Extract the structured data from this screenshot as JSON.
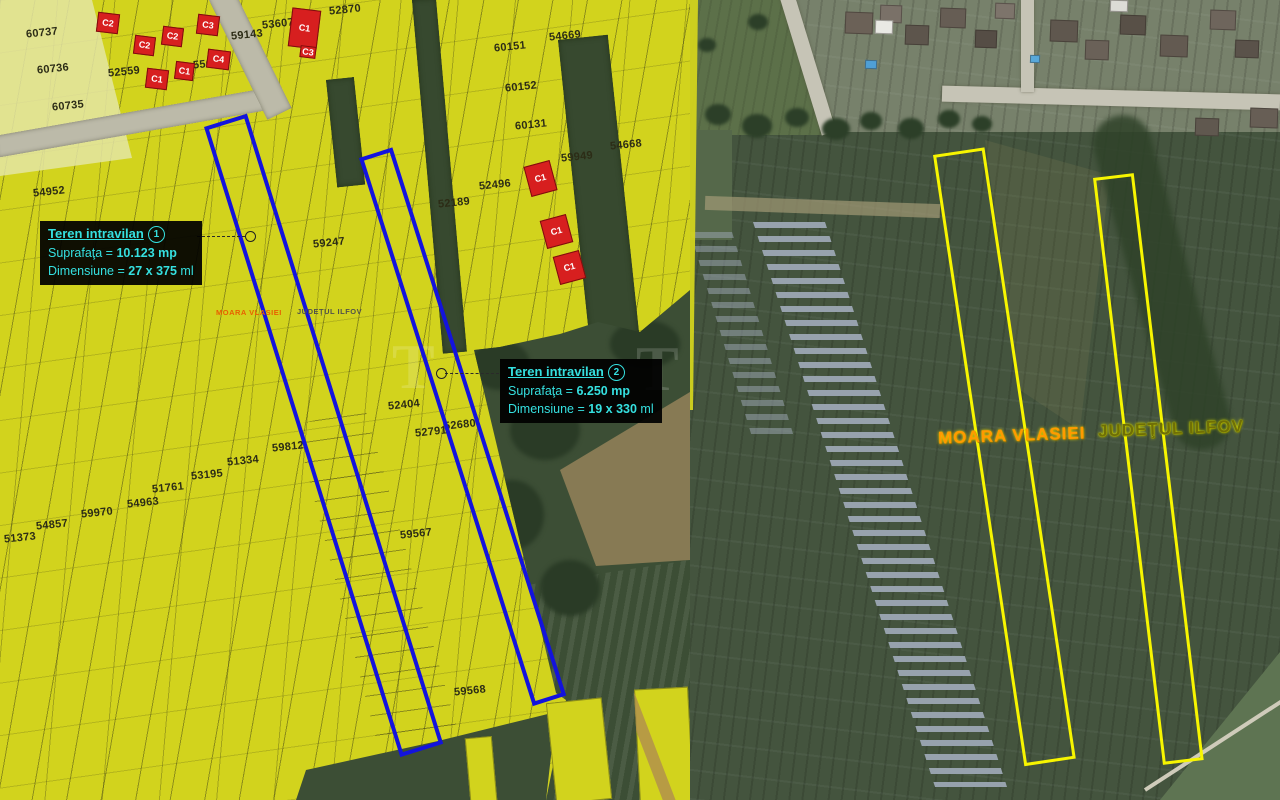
{
  "left_map": {
    "locality_label": "MOARA VLASIEI",
    "county_label": "JUDEŢUL ILFOV",
    "watermark": "T",
    "parcel_numbers": [
      {
        "num": "60737",
        "x": 26,
        "y": 27
      },
      {
        "num": "60736",
        "x": 37,
        "y": 63
      },
      {
        "num": "60735",
        "x": 52,
        "y": 100
      },
      {
        "num": "52559",
        "x": 108,
        "y": 66
      },
      {
        "num": "55695",
        "x": 193,
        "y": 58
      },
      {
        "num": "59143",
        "x": 231,
        "y": 29
      },
      {
        "num": "53607",
        "x": 262,
        "y": 18
      },
      {
        "num": "52870",
        "x": 329,
        "y": 4
      },
      {
        "num": "54669",
        "x": 549,
        "y": 30
      },
      {
        "num": "60151",
        "x": 494,
        "y": 41
      },
      {
        "num": "60152",
        "x": 505,
        "y": 81
      },
      {
        "num": "60131",
        "x": 515,
        "y": 119
      },
      {
        "num": "59949",
        "x": 561,
        "y": 151
      },
      {
        "num": "54668",
        "x": 610,
        "y": 139
      },
      {
        "num": "52496",
        "x": 479,
        "y": 179
      },
      {
        "num": "52189",
        "x": 438,
        "y": 197
      },
      {
        "num": "54952",
        "x": 33,
        "y": 186
      },
      {
        "num": "59247",
        "x": 313,
        "y": 237
      },
      {
        "num": "52404",
        "x": 388,
        "y": 399
      },
      {
        "num": "52791",
        "x": 415,
        "y": 426
      },
      {
        "num": "52680",
        "x": 444,
        "y": 419
      },
      {
        "num": "59812",
        "x": 272,
        "y": 441
      },
      {
        "num": "51334",
        "x": 227,
        "y": 455
      },
      {
        "num": "53195",
        "x": 191,
        "y": 469
      },
      {
        "num": "51761",
        "x": 152,
        "y": 482
      },
      {
        "num": "54963",
        "x": 127,
        "y": 497
      },
      {
        "num": "59970",
        "x": 81,
        "y": 507
      },
      {
        "num": "54857",
        "x": 36,
        "y": 519
      },
      {
        "num": "51373",
        "x": 4,
        "y": 532
      },
      {
        "num": "59567",
        "x": 400,
        "y": 528
      },
      {
        "num": "59568",
        "x": 454,
        "y": 685
      }
    ],
    "buildings": [
      {
        "label": "C2",
        "x": 97,
        "y": 13,
        "w": 20,
        "h": 18,
        "rot": 7
      },
      {
        "label": "C2",
        "x": 134,
        "y": 36,
        "w": 19,
        "h": 17,
        "rot": 7
      },
      {
        "label": "C2",
        "x": 162,
        "y": 27,
        "w": 19,
        "h": 17,
        "rot": 7
      },
      {
        "label": "C3",
        "x": 197,
        "y": 15,
        "w": 20,
        "h": 18,
        "rot": 7
      },
      {
        "label": "C1",
        "x": 146,
        "y": 69,
        "w": 20,
        "h": 18,
        "rot": 7
      },
      {
        "label": "C1",
        "x": 175,
        "y": 62,
        "w": 17,
        "h": 16,
        "rot": 7
      },
      {
        "label": "C4",
        "x": 207,
        "y": 50,
        "w": 21,
        "h": 17,
        "rot": 7
      },
      {
        "label": "C1",
        "x": 290,
        "y": 9,
        "w": 27,
        "h": 37,
        "rot": 7
      },
      {
        "label": "C3",
        "x": 300,
        "y": 46,
        "w": 14,
        "h": 10,
        "rot": 7
      },
      {
        "label": "C1",
        "x": 527,
        "y": 163,
        "w": 25,
        "h": 29,
        "rot": -15
      },
      {
        "label": "C1",
        "x": 543,
        "y": 217,
        "w": 25,
        "h": 27,
        "rot": -15
      },
      {
        "label": "C1",
        "x": 556,
        "y": 253,
        "w": 25,
        "h": 27,
        "rot": -15
      }
    ],
    "annotations": [
      {
        "title": "Teren intravilan",
        "index": "1",
        "area_label": "Suprafaţa =",
        "area_value": "10.123 mp",
        "dim_label": "Dimensiune =",
        "dim_value": "27 x 375",
        "dim_unit": "ml"
      },
      {
        "title": "Teren intravilan",
        "index": "2",
        "area_label": "Suprafaţa =",
        "area_value": "6.250 mp",
        "dim_label": "Dimensiune =",
        "dim_value": "19 x 330",
        "dim_unit": "ml"
      }
    ]
  },
  "right_map": {
    "locality_label": "MOARA VLASIEI",
    "county_label": "JUDEŢUL ILFOV"
  },
  "colors": {
    "parcel_fill": "#d2d31d",
    "boundary_blue": "#1313dd",
    "boundary_yellow": "#f7f500",
    "building_red": "#d71f1f",
    "annotation_cyan": "#35e0e0"
  }
}
